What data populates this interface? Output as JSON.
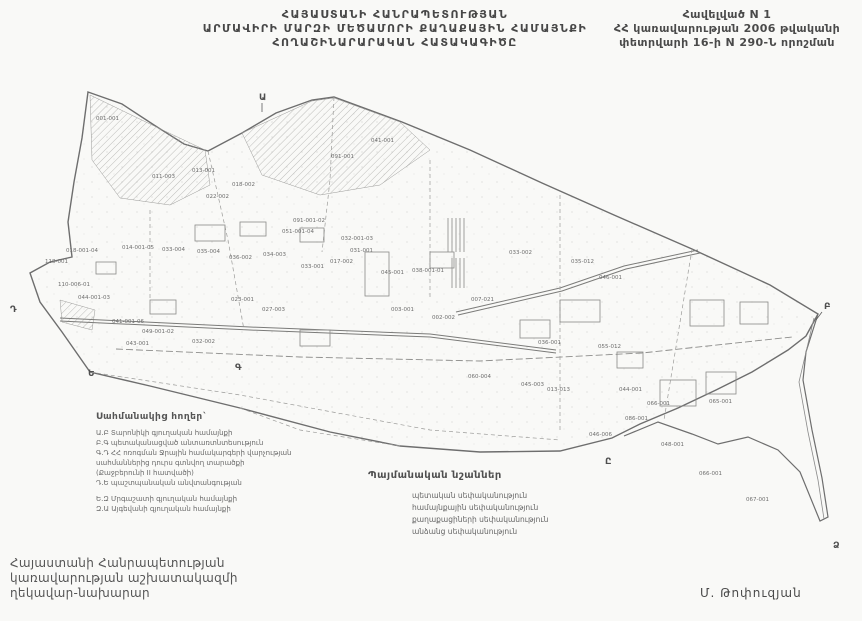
{
  "page": {
    "bg": "#f9f9f7",
    "ink": "#3d3d3d",
    "map_ink": "#787878"
  },
  "header": {
    "title_line1": "ՀԱՅԱՍՏԱՆԻ ՀԱՆՐԱՊԵՏՈՒԹՅԱՆ",
    "title_line2": "ԱՐՄԱՎԻՐԻ ՄԱՐԶԻ ՄԵԾԱՄՈՐԻ ՔԱՂԱՔԱՅԻՆ ՀԱՄԱՅՆՔԻ",
    "title_line3": "ՀՈՂԱՇԻՆԱՐԱՐԱԿԱՆ ՀԱՏԱԿԱԳԻԾԸ"
  },
  "annex": {
    "line1": "Հավելված N 1",
    "line2": "ՀՀ կառավարության 2006 թվականի",
    "line3": "փետրվարի 16-ի N 290-Ն որոշման"
  },
  "adjacent_lands": {
    "title": "Սահմանակից հողեր`",
    "items": [
      "Ա.Բ Տարոնիկի գյուղական համայնքի",
      "Բ.Գ պետականացված անտառտնտեսություն",
      "Գ.Դ ՀՀ ոռոգման Ջրային համակարգերի վարչության",
      "սահմաններից դուրս գտնվող տարածքի",
      "(Քաջբերունի II հատվածի)",
      "Դ.Ե պաշտպանական անվտանգության",
      "Ե.Զ Մրգաշատի գյուղական համայնքի",
      "Զ.Ա Այգեվանի գյուղական համայնքի"
    ]
  },
  "legend": {
    "title": "Պայմանական նշաններ",
    "items": [
      {
        "label": "պետական սեփականություն"
      },
      {
        "label": "համայնքային սեփականություն"
      },
      {
        "label": "քաղաքացիների սեփականություն"
      },
      {
        "label": "անձանց սեփականություն"
      }
    ]
  },
  "signature": {
    "line1": "Հայաստանի Հանրապետության",
    "line2": "կառավարության աշխատակազմի",
    "line3": "ղեկավար-նախարար"
  },
  "signer": "Մ. Թոփուզյան",
  "map": {
    "letters": [
      {
        "t": "Ա",
        "x": 259,
        "y": 100
      },
      {
        "t": "Բ",
        "x": 824,
        "y": 309
      },
      {
        "t": "Գ",
        "x": 235,
        "y": 370
      },
      {
        "t": "Դ",
        "x": 10,
        "y": 312
      },
      {
        "t": "Ե",
        "x": 88,
        "y": 376
      },
      {
        "t": "Ը",
        "x": 605,
        "y": 464
      },
      {
        "t": "Ձ",
        "x": 833,
        "y": 548
      }
    ],
    "parcels": [
      {
        "c": "001-001",
        "x": 96,
        "y": 120
      },
      {
        "c": "041-001",
        "x": 371,
        "y": 142
      },
      {
        "c": "091-001",
        "x": 331,
        "y": 158
      },
      {
        "c": "013-001",
        "x": 192,
        "y": 172
      },
      {
        "c": "011-003",
        "x": 152,
        "y": 178
      },
      {
        "c": "018-002",
        "x": 232,
        "y": 186
      },
      {
        "c": "022-002",
        "x": 206,
        "y": 198
      },
      {
        "c": "091-001-02",
        "x": 293,
        "y": 222
      },
      {
        "c": "051-001-04",
        "x": 282,
        "y": 233
      },
      {
        "c": "032-001-03",
        "x": 341,
        "y": 240
      },
      {
        "c": "031-001",
        "x": 350,
        "y": 252
      },
      {
        "c": "017-002",
        "x": 330,
        "y": 263
      },
      {
        "c": "045-001",
        "x": 381,
        "y": 274
      },
      {
        "c": "038-001-01",
        "x": 412,
        "y": 272
      },
      {
        "c": "033-001",
        "x": 301,
        "y": 268
      },
      {
        "c": "034-003",
        "x": 263,
        "y": 256
      },
      {
        "c": "036-002",
        "x": 229,
        "y": 259
      },
      {
        "c": "035-004",
        "x": 197,
        "y": 253
      },
      {
        "c": "033-004",
        "x": 162,
        "y": 251
      },
      {
        "c": "014-001-05",
        "x": 122,
        "y": 249
      },
      {
        "c": "018-001-04",
        "x": 66,
        "y": 252
      },
      {
        "c": "118-001",
        "x": 45,
        "y": 263
      },
      {
        "c": "110-006-01",
        "x": 58,
        "y": 286
      },
      {
        "c": "044-001-03",
        "x": 78,
        "y": 299
      },
      {
        "c": "041-001-06",
        "x": 112,
        "y": 323
      },
      {
        "c": "049-001-02",
        "x": 142,
        "y": 333
      },
      {
        "c": "043-001",
        "x": 126,
        "y": 345
      },
      {
        "c": "032-002",
        "x": 192,
        "y": 343
      },
      {
        "c": "023-001",
        "x": 231,
        "y": 301
      },
      {
        "c": "027-003",
        "x": 262,
        "y": 311
      },
      {
        "c": "003-001",
        "x": 391,
        "y": 311
      },
      {
        "c": "002-002",
        "x": 432,
        "y": 319
      },
      {
        "c": "007-021",
        "x": 471,
        "y": 301
      },
      {
        "c": "033-002",
        "x": 509,
        "y": 254
      },
      {
        "c": "035-012",
        "x": 571,
        "y": 263
      },
      {
        "c": "046-001",
        "x": 599,
        "y": 279
      },
      {
        "c": "036-001",
        "x": 538,
        "y": 344
      },
      {
        "c": "055-012",
        "x": 598,
        "y": 348
      },
      {
        "c": "060-004",
        "x": 468,
        "y": 378
      },
      {
        "c": "045-003",
        "x": 521,
        "y": 386
      },
      {
        "c": "013-013",
        "x": 547,
        "y": 391
      },
      {
        "c": "044-001",
        "x": 619,
        "y": 391
      },
      {
        "c": "066-001",
        "x": 647,
        "y": 405
      },
      {
        "c": "065-001",
        "x": 709,
        "y": 403
      },
      {
        "c": "066-001",
        "x": 699,
        "y": 475
      },
      {
        "c": "067-001",
        "x": 746,
        "y": 501
      },
      {
        "c": "046-006",
        "x": 589,
        "y": 436
      },
      {
        "c": "048-001",
        "x": 661,
        "y": 446
      },
      {
        "c": "086-001",
        "x": 625,
        "y": 420
      }
    ]
  }
}
